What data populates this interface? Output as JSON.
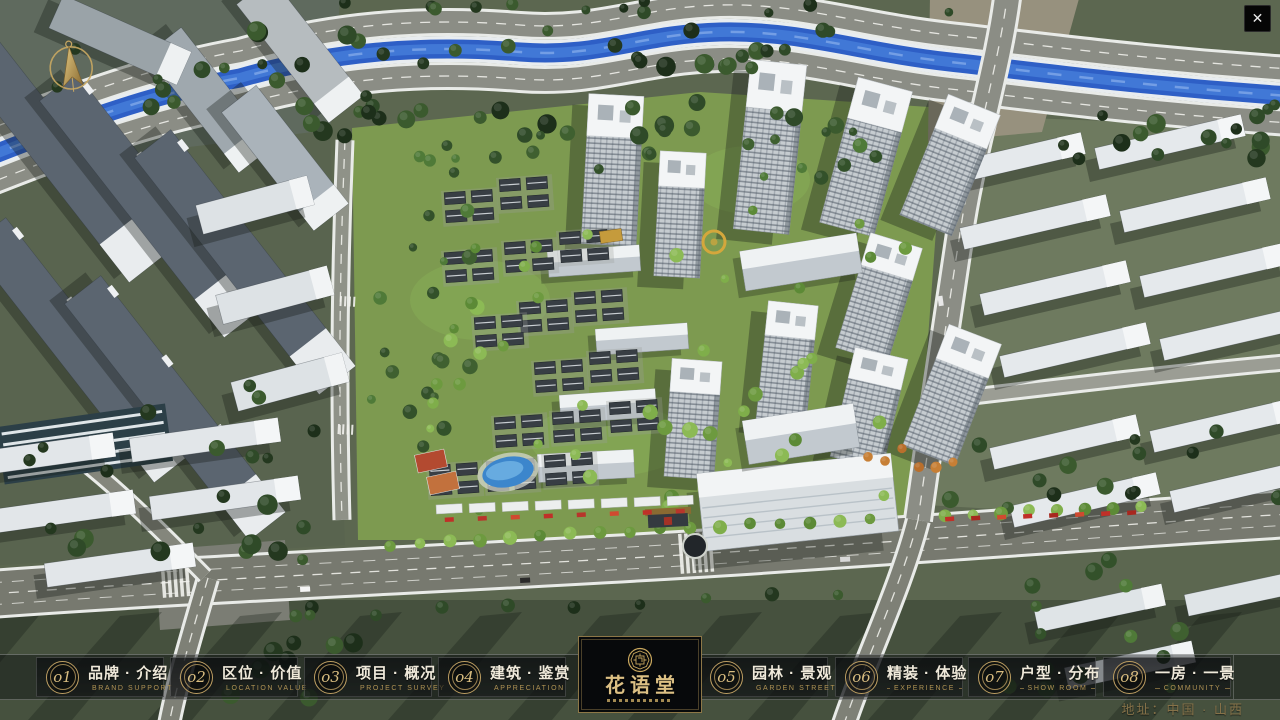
{
  "window": {
    "close_icon": "✕"
  },
  "nav": {
    "items": [
      {
        "number": "o1",
        "title": "品牌 · 介绍",
        "subtitle": "BRAND SUPPORT"
      },
      {
        "number": "o2",
        "title": "区位 · 价值",
        "subtitle": "LOCATION VALUE"
      },
      {
        "number": "o3",
        "title": "项目 · 概况",
        "subtitle": "PROJECT SURVEY"
      },
      {
        "number": "o4",
        "title": "建筑 · 鉴赏",
        "subtitle": "APPRECIATION"
      },
      {
        "number": "o5",
        "title": "园林 · 景观",
        "subtitle": "GARDEN STREET"
      },
      {
        "number": "o6",
        "title": "精装 · 体验",
        "subtitle": "EXPERIENCE"
      },
      {
        "number": "o7",
        "title": "户型 · 分布",
        "subtitle": "SHOW ROOM"
      },
      {
        "number": "o8",
        "title": "一房 · 一景",
        "subtitle": "COMMUNITY"
      }
    ]
  },
  "logo": {
    "title": "花语堂"
  },
  "footer": {
    "address": "地址：中国 · 山西"
  },
  "icons": {
    "compass": "north-compass-icon",
    "close": "close-icon",
    "seal": "brand-seal-icon"
  },
  "colors": {
    "gold": "#c2a264",
    "bar_background": "rgba(10,12,14,0.42)",
    "river": "#2e5fc6",
    "site_green": "#7d9a50"
  }
}
